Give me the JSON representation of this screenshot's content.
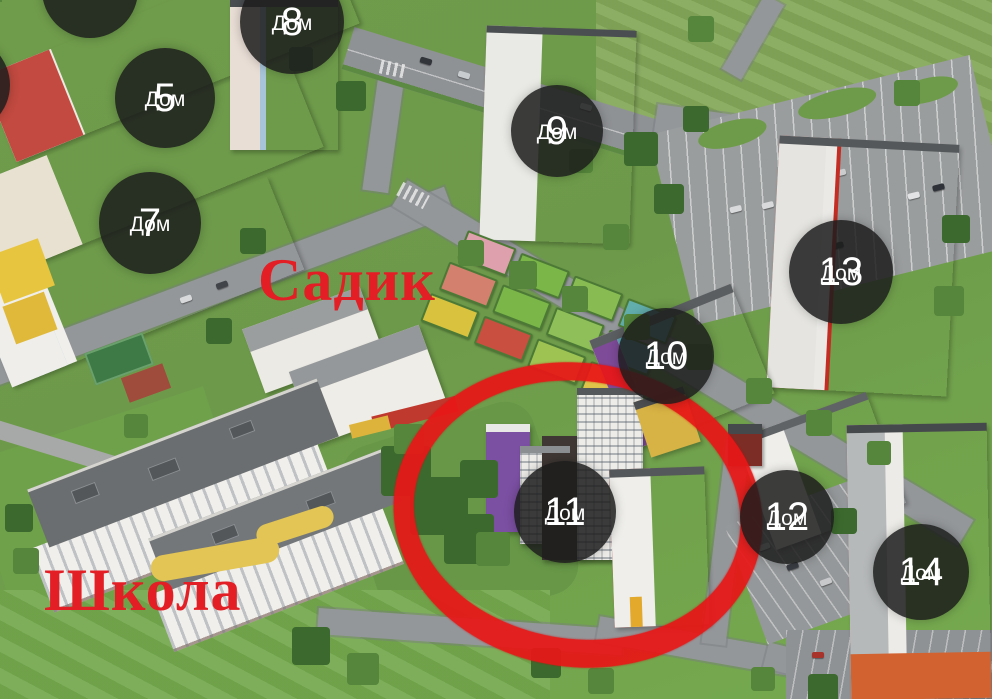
{
  "labels": {
    "kindergarten": "Садик",
    "school": "Школа"
  },
  "badges": [
    {
      "number": "5",
      "label": "Дом",
      "x": 115,
      "y": 48,
      "size": 100
    },
    {
      "number": "7",
      "label": "Дом",
      "x": 99,
      "y": 172,
      "size": 102
    },
    {
      "number": "8",
      "label": "Дом",
      "x": 240,
      "y": -30,
      "size": 104
    },
    {
      "number": "9",
      "label": "Дом",
      "x": 511,
      "y": 85,
      "size": 92
    },
    {
      "number": "10",
      "label": "Дом",
      "x": 618,
      "y": 308,
      "size": 96
    },
    {
      "number": "11",
      "label": "Дом",
      "x": 514,
      "y": 461,
      "size": 102
    },
    {
      "number": "12",
      "label": "Дом",
      "x": 740,
      "y": 470,
      "size": 94
    },
    {
      "number": "13",
      "label": "Дом",
      "x": 789,
      "y": 220,
      "size": 104
    },
    {
      "number": "14",
      "label": "Дом",
      "x": 873,
      "y": 524,
      "size": 96
    },
    {
      "partial": true,
      "x": 42,
      "y": -58,
      "size": 96
    },
    {
      "partial": true,
      "x": -86,
      "y": 37,
      "size": 96
    }
  ],
  "highlight": {
    "shape": "ellipse",
    "target": "Дом 11",
    "x": 393,
    "y": 363,
    "width": 370,
    "height": 304,
    "rotation_deg": 8
  },
  "colors": {
    "badge-bg": "rgba(28,28,28,0.85)",
    "badge-text": "#ffffff",
    "label-red": "#e31e25",
    "highlight-red": "#e81717"
  }
}
